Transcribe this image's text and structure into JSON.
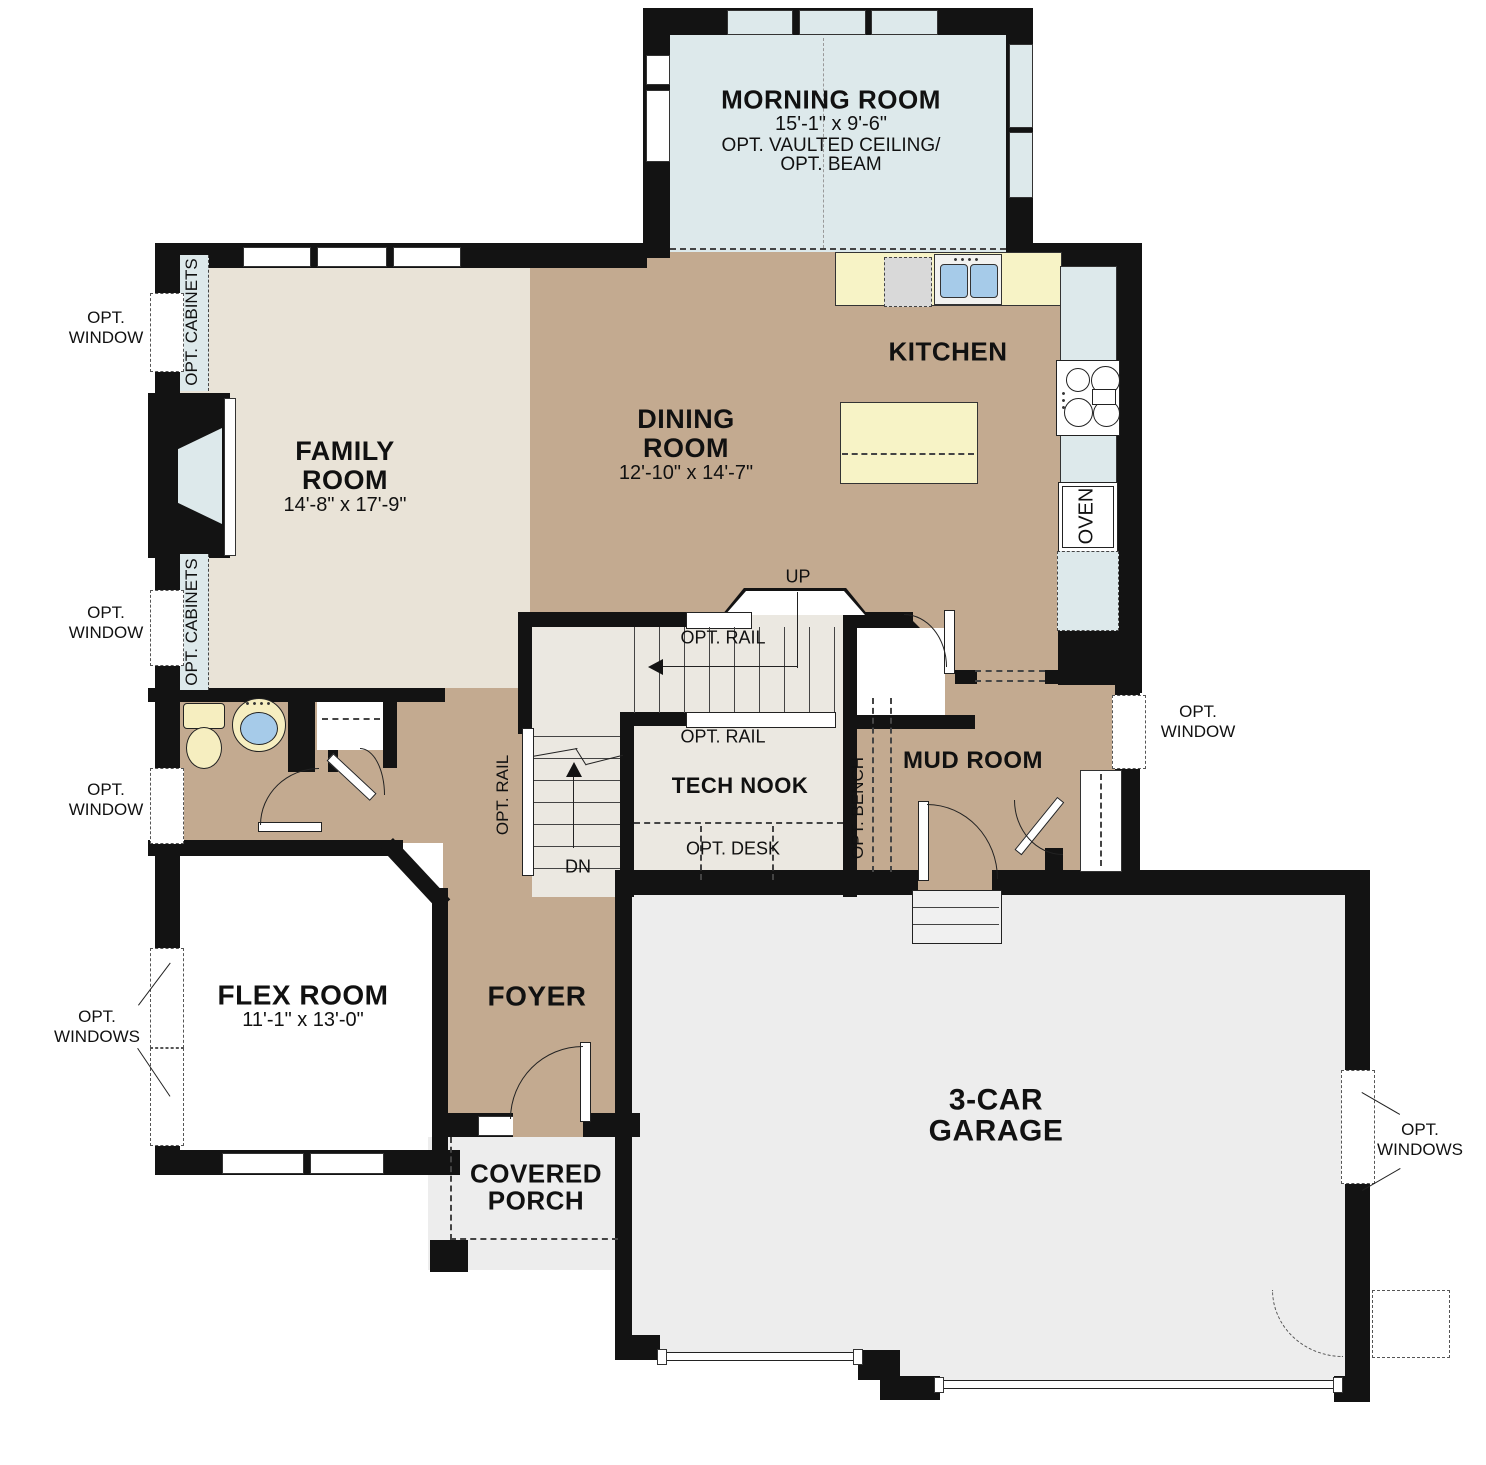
{
  "colors": {
    "wall": "#131313",
    "tan": "#c3aa90",
    "beige": "#e9e3d7",
    "gray": "#ededed",
    "stair": "#ebe8e1",
    "blue": "#dde9eb",
    "counter": "#f7f3c6",
    "fixture": "#f6eec0",
    "water": "#a6cbe9",
    "paper": "#ffffff"
  },
  "rooms": {
    "morning": {
      "title": "MORNING ROOM",
      "dims": "15'-1\" x 9'-6\"",
      "note1": "OPT. VAULTED CEILING/",
      "note2": "OPT. BEAM"
    },
    "family": {
      "title1": "FAMILY",
      "title2": "ROOM",
      "dims": "14'-8\" x 17'-9\""
    },
    "dining": {
      "title1": "DINING",
      "title2": "ROOM",
      "dims": "12'-10\" x 14'-7\""
    },
    "kitchen": {
      "title": "KITCHEN",
      "oven": "OVEN"
    },
    "flex": {
      "title": "FLEX ROOM",
      "dims": "11'-1\" x 13'-0\""
    },
    "foyer": {
      "title": "FOYER"
    },
    "tech_nook": {
      "title": "TECH NOOK"
    },
    "mud_room": {
      "title": "MUD ROOM"
    },
    "garage": {
      "title1": "3-CAR",
      "title2": "GARAGE"
    },
    "porch": {
      "title1": "COVERED",
      "title2": "PORCH"
    }
  },
  "annotations": {
    "opt_window_l1": "OPT.",
    "opt_window_l2": "WINDOW",
    "opt_windows_l1": "OPT.",
    "opt_windows_l2": "WINDOWS",
    "opt_cabinets": "OPT. CABINETS",
    "opt_rail": "OPT. RAIL",
    "opt_bench": "OPT. BENCH",
    "opt_desk": "OPT. DESK",
    "up": "UP",
    "dn": "DN"
  }
}
